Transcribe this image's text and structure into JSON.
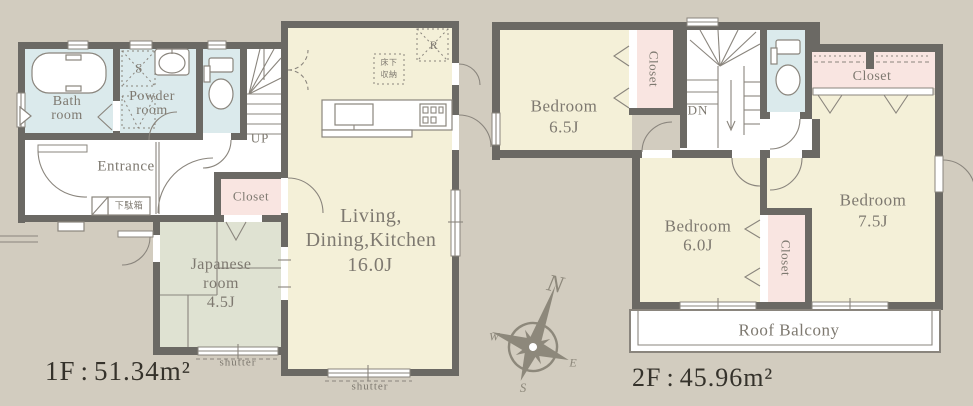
{
  "palette": {
    "background": "#d2ccbf",
    "room_cream": "#f4f0d8",
    "room_blue": "#dbeaec",
    "room_pink": "#f9e5e1",
    "room_green": "#dfe2d2",
    "wall": "#6b6964",
    "line": "#8a857d",
    "label_gray": "#7e7970",
    "label_dark": "#35322b"
  },
  "floor_1f": {
    "area_label": {
      "floor": "1F",
      "colon": ":",
      "value": "51.34",
      "unit": "m²"
    },
    "rooms": {
      "bath_line1": "Bath",
      "bath_line2": "room",
      "powder_line1": "Powder",
      "powder_line2": "room",
      "entrance": "Entrance",
      "closet": "Closet",
      "japanese_line1": "Japanese",
      "japanese_line2": "room",
      "japanese_size": "4.5J",
      "ldk_line1": "Living,",
      "ldk_line2": "Dining,Kitchen",
      "ldk_size": "16.0J"
    },
    "annotations": {
      "up": "UP",
      "shoe_cabinet": "下駄箱",
      "underfloor_line1": "床下",
      "underfloor_line2": "収納",
      "refrigerator": "R",
      "storage": "S",
      "shutter_japanese": "shutter",
      "shutter_ldk": "shutter"
    }
  },
  "floor_2f": {
    "area_label": {
      "floor": "2F",
      "colon": ":",
      "value": "45.96",
      "unit": "m²"
    },
    "rooms": {
      "bedroom1_name": "Bedroom",
      "bedroom1_size": "6.5J",
      "bedroom2_name": "Bedroom",
      "bedroom2_size": "6.0J",
      "bedroom3_name": "Bedroom",
      "bedroom3_size": "7.5J",
      "closet_west": "Closet",
      "closet_north": "Closet",
      "closet_mid": "Closet",
      "balcony": "Roof Balcony"
    },
    "annotations": {
      "down": "DN"
    }
  },
  "compass": {
    "north": "N",
    "west": "W",
    "east": "E",
    "south": "S"
  }
}
